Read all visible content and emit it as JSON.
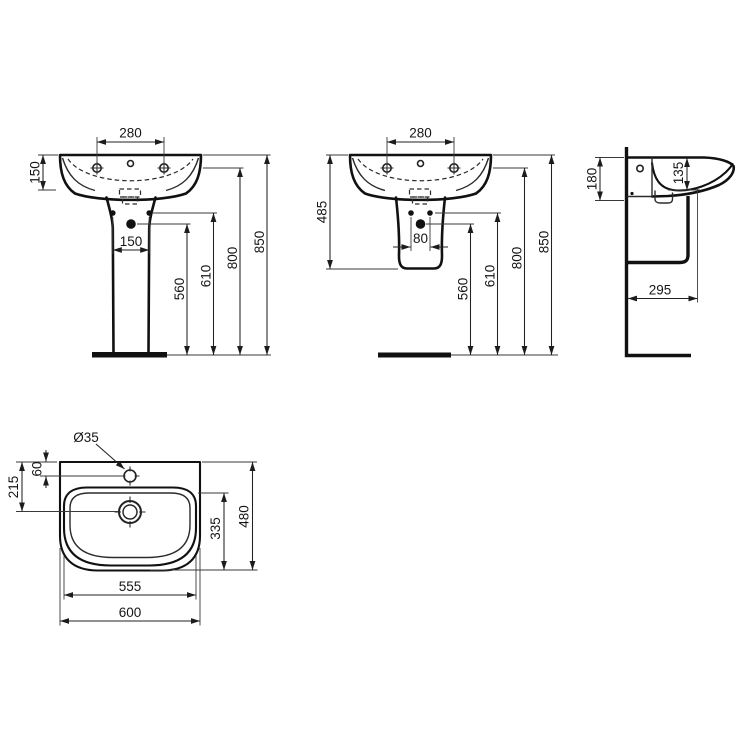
{
  "colors": {
    "line": "#1c1c1c",
    "background": "#ffffff"
  },
  "views": [
    {
      "id": "front-view-pedestal",
      "labels": {
        "fixing_holes_span": "280",
        "rim_drop": "150",
        "pedestal_holes_span": "150",
        "h560": "560",
        "h610": "610",
        "h800": "800",
        "h850": "850"
      }
    },
    {
      "id": "front-view-semi-pedestal",
      "labels": {
        "fixing_holes_span": "280",
        "rim_to_semi_pedestal_bottom": "485",
        "pedestal_holes_span": "80",
        "h560": "560",
        "h610": "610",
        "h800": "800",
        "h850": "850"
      }
    },
    {
      "id": "side-view",
      "labels": {
        "overhang": "180",
        "bowl_depth": "135",
        "wall_to_front": "295"
      }
    },
    {
      "id": "top-view",
      "labels": {
        "tap_hole_diameter": "Ø35",
        "back_to_tap": "60",
        "back_to_drain": "215",
        "bowl_length": "335",
        "overall_depth": "480",
        "bowl_width": "555",
        "overall_width": "600"
      }
    }
  ]
}
